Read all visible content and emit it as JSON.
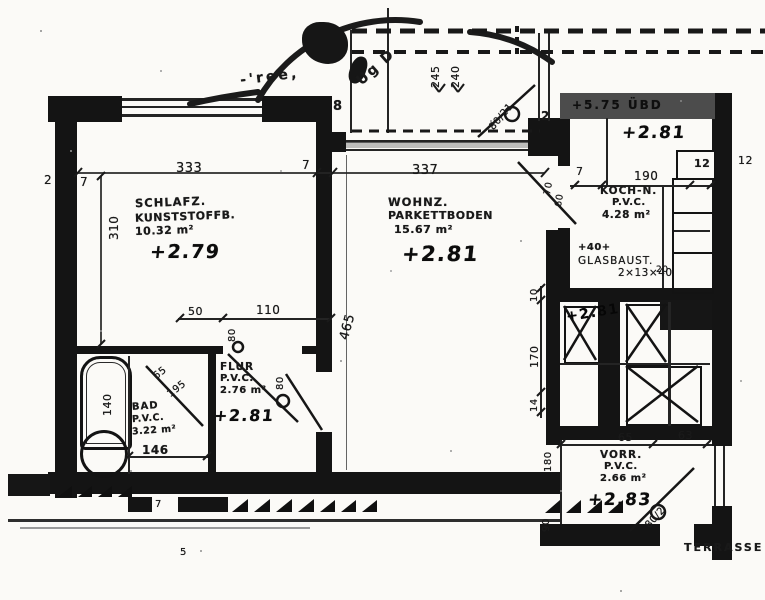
{
  "stamp": {
    "text_left": "-'ree,",
    "text_right": "Ug D."
  },
  "rooms": {
    "schlafz": {
      "name": "SCHLAFZ.",
      "floor": "KUNSTSTOFFB.",
      "area": "10.32 m²",
      "level": "+2.79"
    },
    "wohnz": {
      "name": "WOHNZ.",
      "floor": "PARKETTBODEN",
      "area": "15.67 m²",
      "level": "+2.81"
    },
    "kochn": {
      "name": "KOCH-N.",
      "floor": "P.V.C.",
      "area": "4.28 m²",
      "level": "+2.81"
    },
    "bad": {
      "name": "BAD",
      "floor": "P.V.C.",
      "area": "3.22 m²"
    },
    "flur": {
      "name": "FLUR",
      "floor": "P.V.C.",
      "area": "2.76 m²",
      "level": "+2.81"
    },
    "vorr": {
      "name": "VORR.",
      "floor": "P.V.C.",
      "area": "2.66 m²",
      "level": "+2.83"
    },
    "stair": {
      "level": "+2.81"
    }
  },
  "annotations": {
    "ubd_band": "+5.75 ÜBD",
    "glas_marker": "+40+",
    "glas_name": "GLASBAUST.",
    "glas_size": "2×13×40",
    "terrasse": "TERRASSE"
  },
  "dims": {
    "schlafz_width": "333",
    "schlafz_height": "310",
    "wall_a": "2",
    "wall_b": "7",
    "wall_c": "7",
    "wohnz_width": "337",
    "wohnz_height": "465",
    "balcony_a": "245",
    "balcony_b": "240",
    "pier": "2",
    "stamp_mark": "8",
    "terrace_door": "80/21",
    "koch_door_a": "70",
    "koch_door_b": "60",
    "kochn_wall": "7",
    "kochn_width": "190",
    "kochn_notch": "12",
    "kochn_edge": "12",
    "kochn_small": "20",
    "wohnz_r_a": "10",
    "wohnz_r_b": "170",
    "wohnz_r_c": "14",
    "flur_a": "50",
    "flur_b": "110",
    "door_schlafz": "80",
    "door_flur": "80",
    "bad_tub": "140",
    "bad_width": "146",
    "bad_door_w": "65",
    "bad_door_h": "195",
    "vorr_a": "65",
    "vorr_b": "63",
    "vorr_left": "180",
    "vorr_door": "80/2",
    "vorr_bottom": "90",
    "bottom_a": "7",
    "bottom_b": "5"
  }
}
